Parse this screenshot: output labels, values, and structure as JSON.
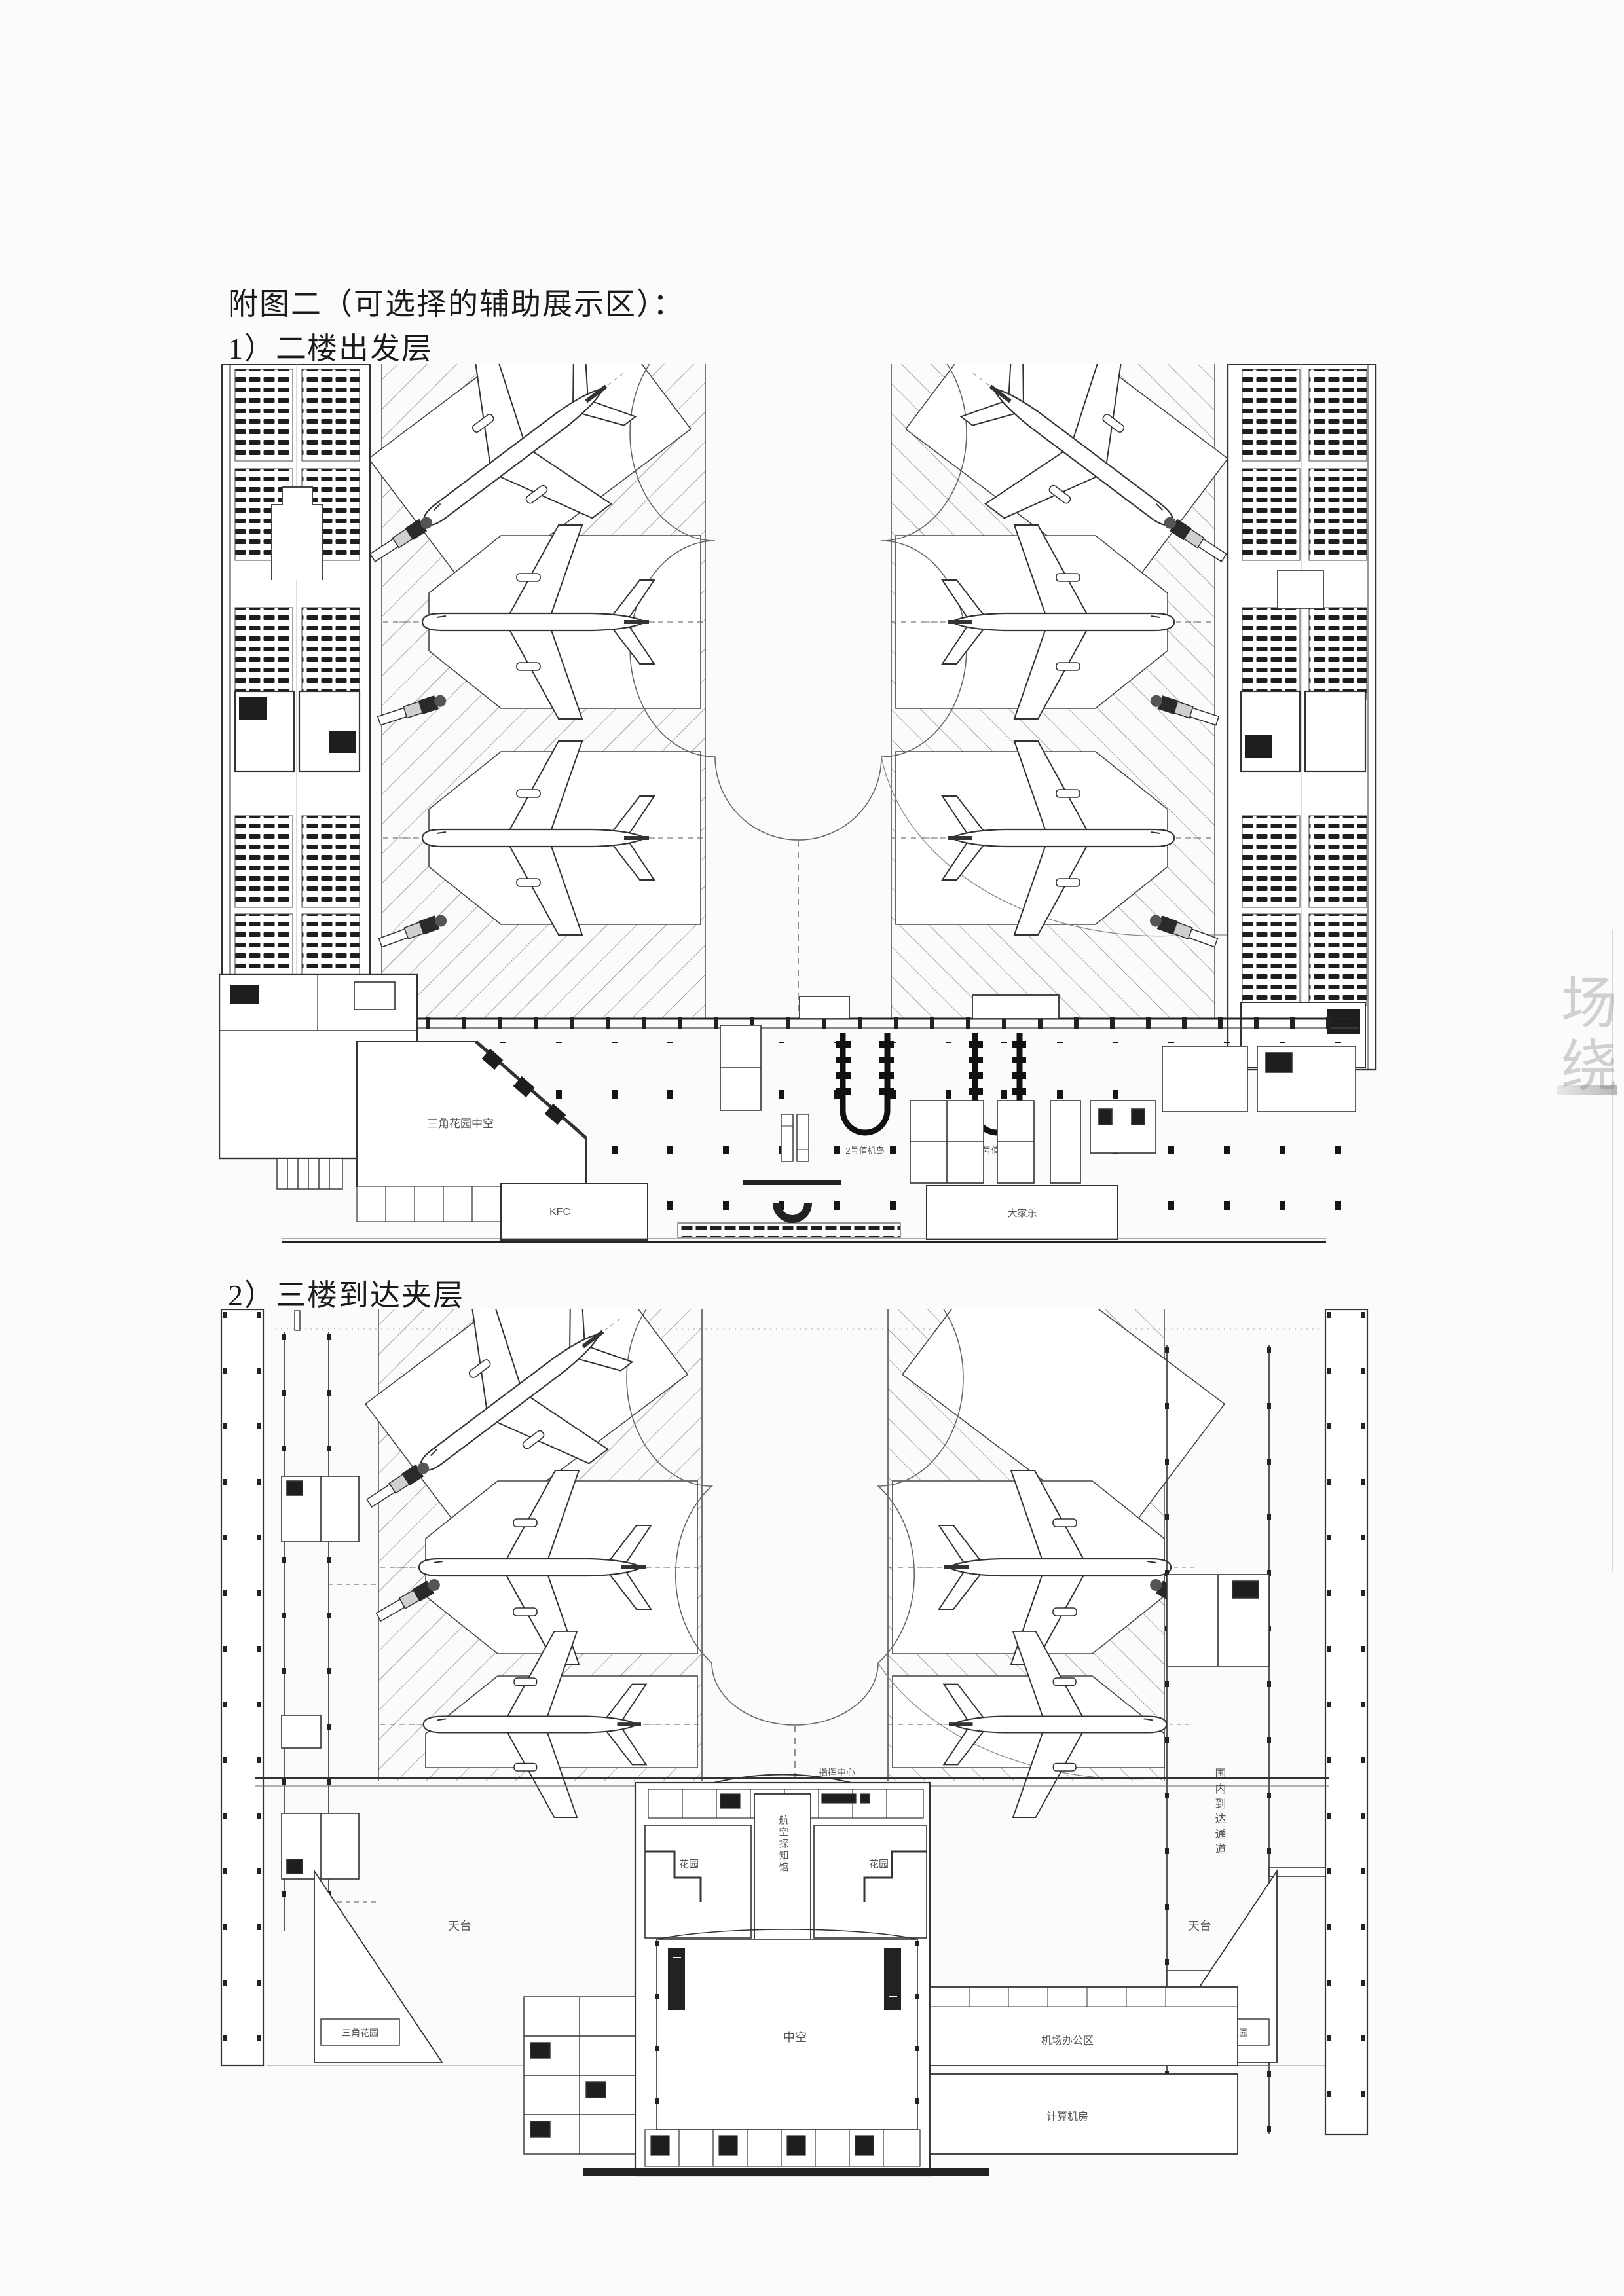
{
  "page": {
    "title": "附图二（可选择的辅助展示区）：",
    "caption1": "1）二楼出发层",
    "caption2": "2）三楼到达夹层",
    "margin_marks": [
      "场",
      "绕"
    ]
  },
  "plan1": {
    "labels": {
      "checkin_island_left": "2号值机岛",
      "checkin_island_right": "4号值机岛",
      "triangle_garden": "三角花园中空",
      "kfc": "KFC",
      "restaurant": "大家乐"
    }
  },
  "plan2": {
    "labels": {
      "command_center": "指挥中心",
      "aviation_hall": "航空探知馆",
      "garden_left": "花园",
      "garden_right": "花园",
      "terrace_left": "天台",
      "terrace_right": "天台",
      "triangle_left": "三角花园",
      "triangle_right": "三角花园",
      "atrium": "中空",
      "airport_office": "机场办公区",
      "computer_room": "计算机房",
      "arrival_corridor": "国内到达通道"
    }
  }
}
